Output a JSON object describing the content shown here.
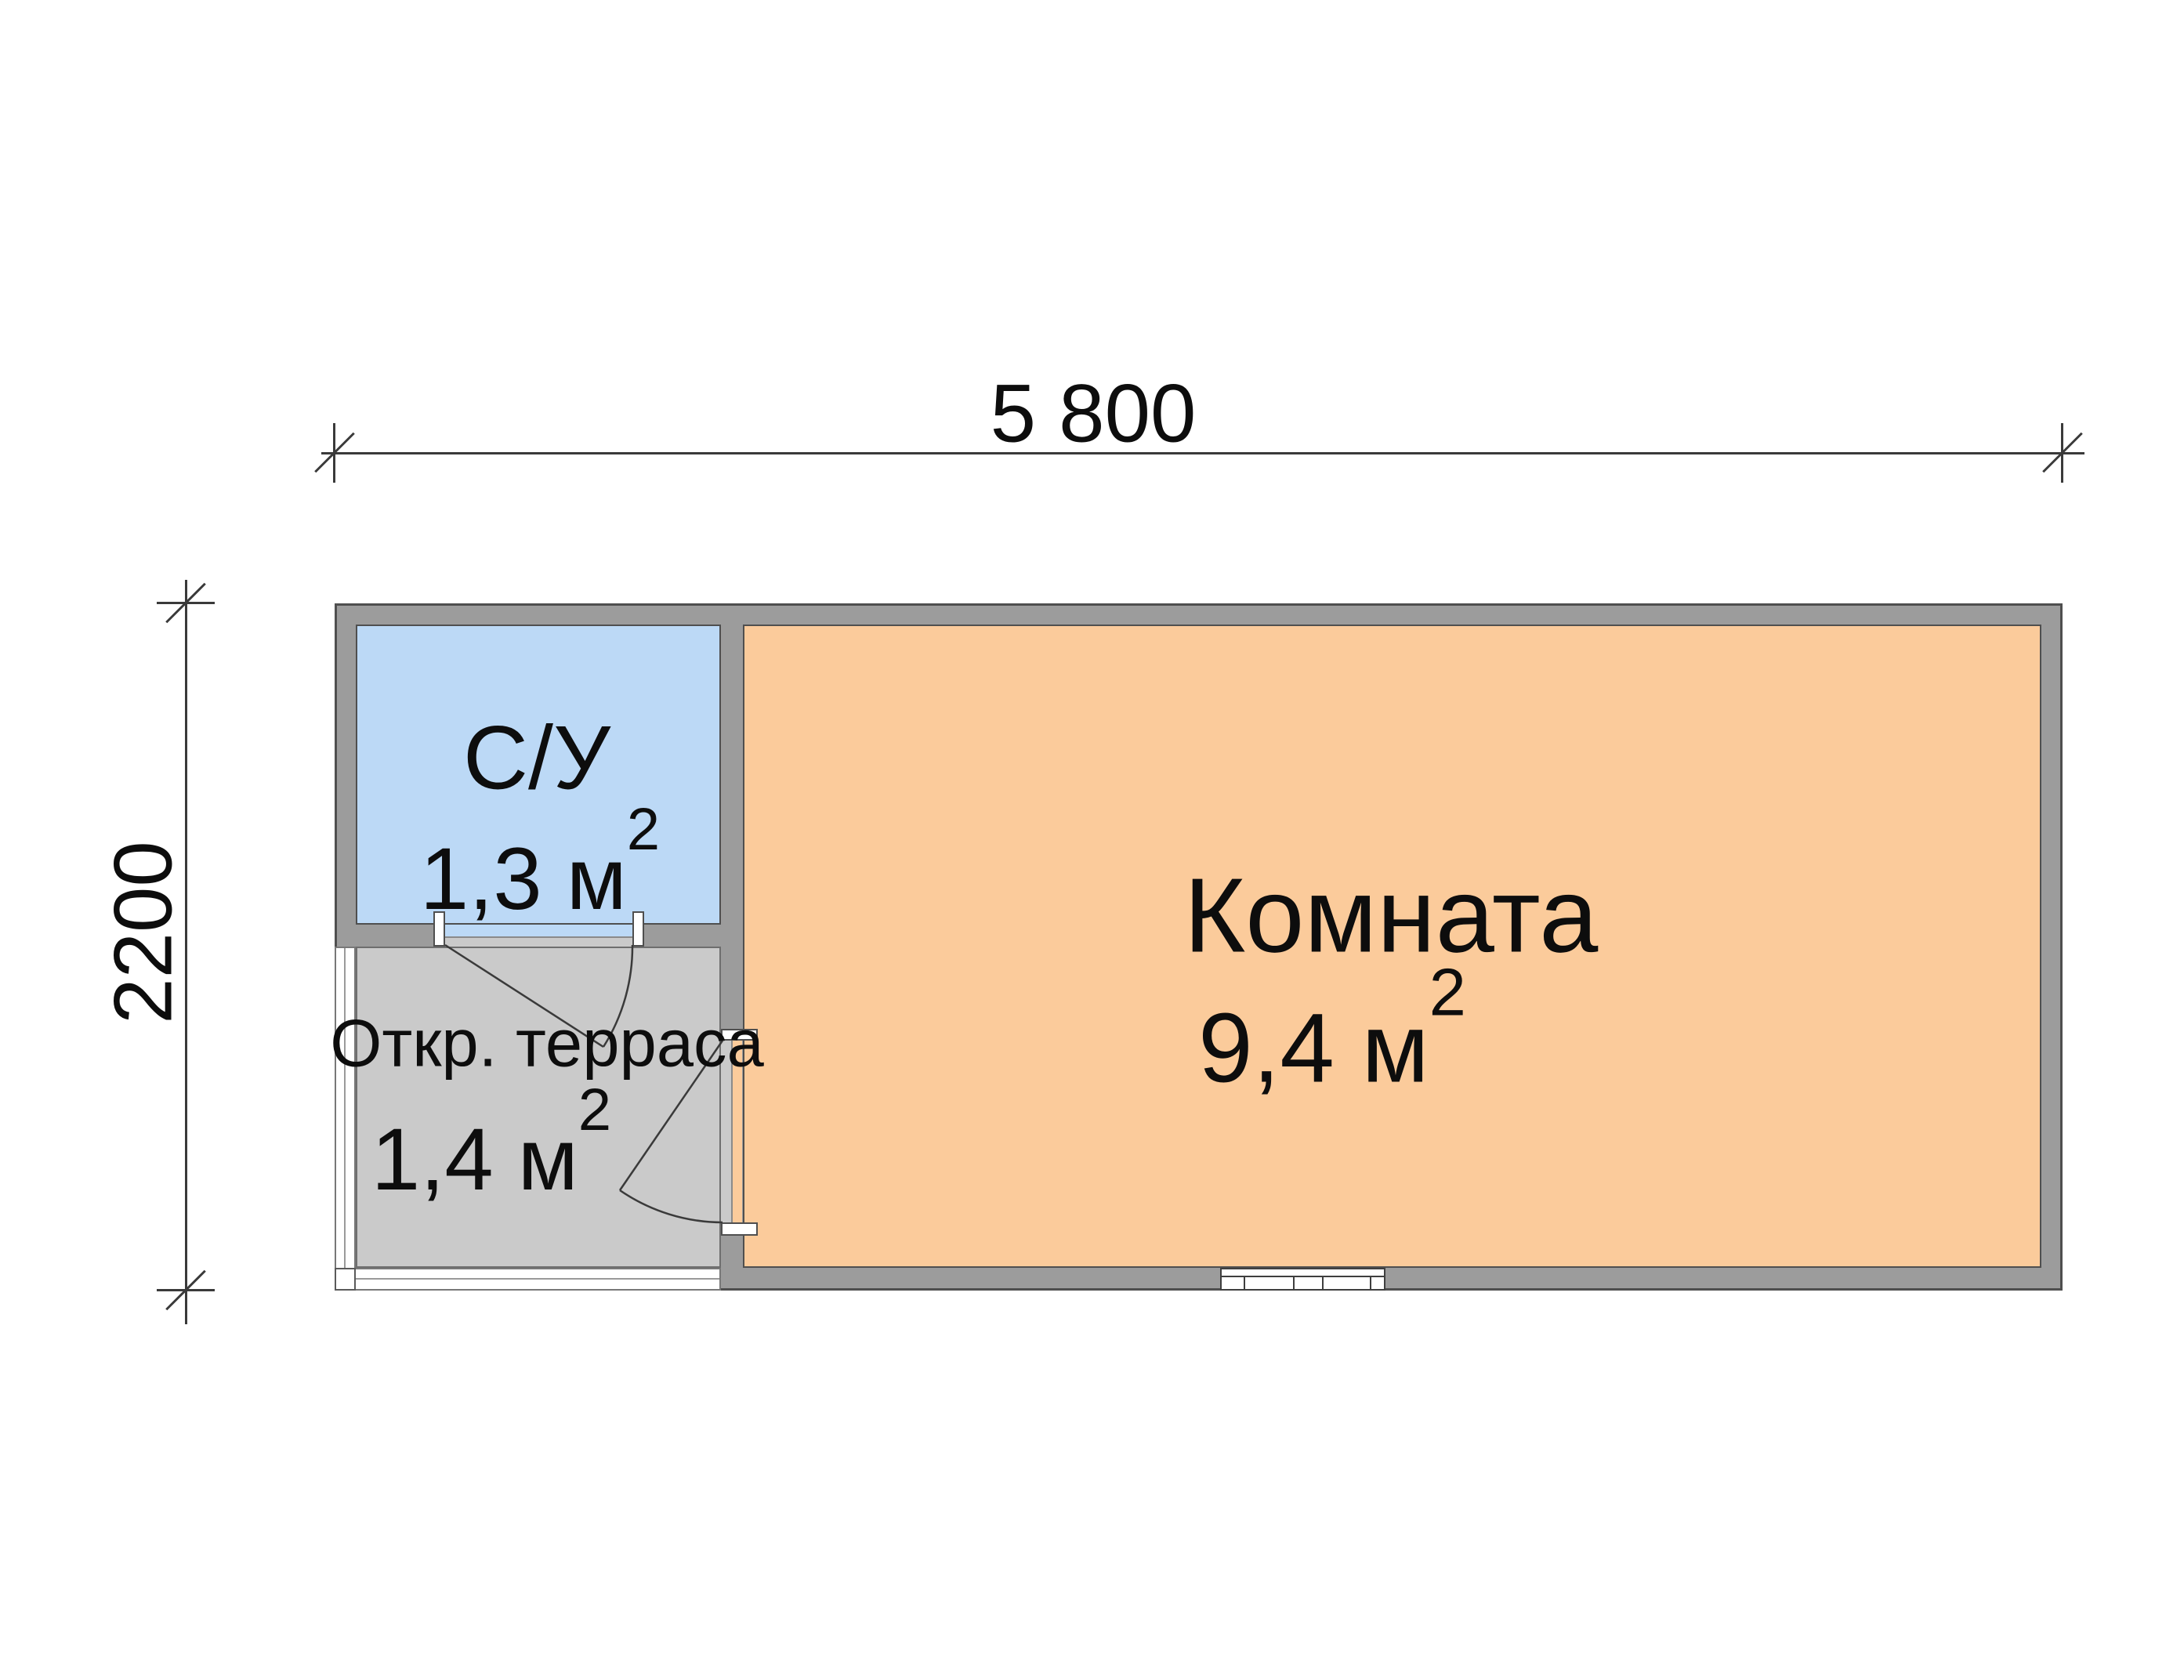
{
  "plan": {
    "dimension_top": {
      "label": "5 800"
    },
    "dimension_left": {
      "label": "2200"
    },
    "rooms": {
      "bathroom": {
        "name": "С/У",
        "area": "1,3 м",
        "area_sup": "2"
      },
      "terrace": {
        "name": "Откр. терраса",
        "area": "1,4 м",
        "area_sup": "2"
      },
      "main": {
        "name": "Комната",
        "area": "9,4 м",
        "area_sup": "2"
      }
    },
    "colors": {
      "wall_fill": "#9c9c9c",
      "wall_outline": "#4f4f4f",
      "bathroom_fill": "#bcd9f6",
      "room_fill": "#fbcb9b",
      "terrace_fill": "#cacaca",
      "line_color": "#3a3a3a",
      "text_color": "#0d0d0d"
    }
  }
}
